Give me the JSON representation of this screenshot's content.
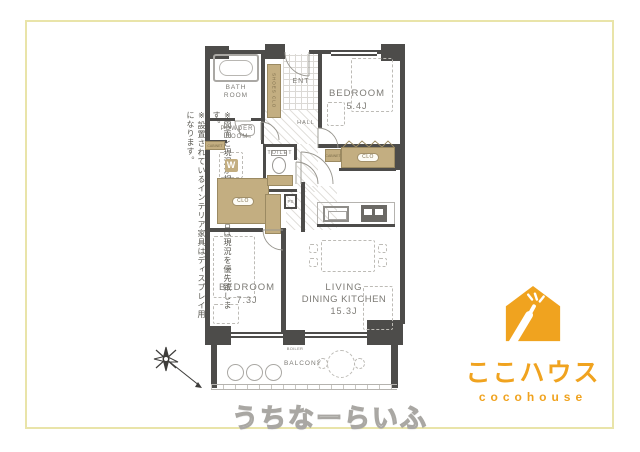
{
  "colors": {
    "wall": "#4d4c4a",
    "closet_fill": "#c3ae81",
    "closet_border": "#9b8a62",
    "frame_border": "#e9e4a9",
    "logo_orange": "#f0a31f"
  },
  "disclaimer": {
    "line1": "※図面と現況が相違する場合は現況を優先致します。",
    "line2": "※設置されているインテリア家具はディスプレイ用になります。"
  },
  "floorplan": {
    "rooms": {
      "bathroom": {
        "label": "BATH ROOM"
      },
      "powder": {
        "label": "POWDER ROOM"
      },
      "toilet": {
        "label": "TOILET"
      },
      "entrance": {
        "label": "ENT"
      },
      "hall": {
        "label": "HALL"
      },
      "shoes_closet": {
        "label": "SHOES CLO"
      },
      "bedroom_upper": {
        "label": "BEDROOM",
        "size": "5.4J"
      },
      "bedroom_lower": {
        "label": "BEDROOM",
        "size": "7.3J"
      },
      "ldk": {
        "line1": "LIVING",
        "line2": "DINING KITCHEN",
        "size": "15.3J"
      },
      "balcony": {
        "label": "BALCONY"
      }
    },
    "fixtures": {
      "washer": "W",
      "closet": "CLO",
      "pipe_space": "PS",
      "cabinet": "CABINET",
      "boiler": "BOILER"
    }
  },
  "watermark": {
    "text": "うちなーらいふ"
  },
  "logo": {
    "title_jp": "ここハウス",
    "title_en": "cocohouse"
  }
}
